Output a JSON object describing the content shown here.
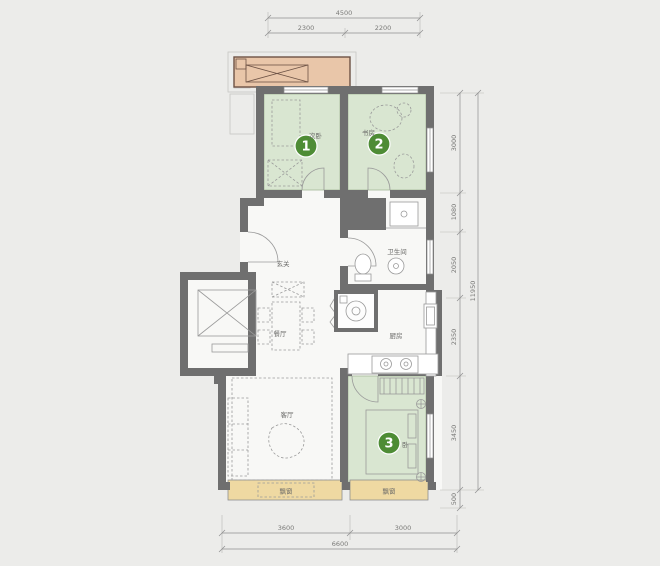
{
  "title": "apartment-floor-plan",
  "colors": {
    "background": "#ececea",
    "floor": "#f8f8f6",
    "wall": "#6f6f6f",
    "bedroom_fill": "#d9e6d1",
    "balcony_fill": "#e9c6a9",
    "balcony_border": "#6d5245",
    "bay_window_fill": "#efd9a2",
    "room_number_badge": "#4e8c35",
    "dimension_line": "#8f8f8f",
    "furniture_line": "#9a9a9a",
    "label_text": "#6a6a68"
  },
  "dimensions": {
    "top": {
      "total": "4500",
      "segments": [
        "2300",
        "2200"
      ]
    },
    "right": {
      "total": "11950",
      "segments": [
        "3000",
        "1080",
        "2050",
        "2350",
        "3450",
        "500"
      ]
    },
    "bottom": {
      "total": "6600",
      "segments": [
        "3600",
        "3000"
      ]
    }
  },
  "rooms": {
    "bedroom1": {
      "number": "1",
      "label": "次卧"
    },
    "bedroom2": {
      "number": "2",
      "label": "书房"
    },
    "bedroom3": {
      "number": "3",
      "label": "卧"
    },
    "entry": {
      "label": "玄关"
    },
    "bathroom": {
      "label": "卫生间"
    },
    "dining": {
      "label": "餐厅"
    },
    "kitchen": {
      "label": "厨房"
    },
    "living": {
      "label": "客厅"
    },
    "bay_left": {
      "label": "飘窗"
    },
    "bay_right": {
      "label": "飘窗"
    }
  }
}
